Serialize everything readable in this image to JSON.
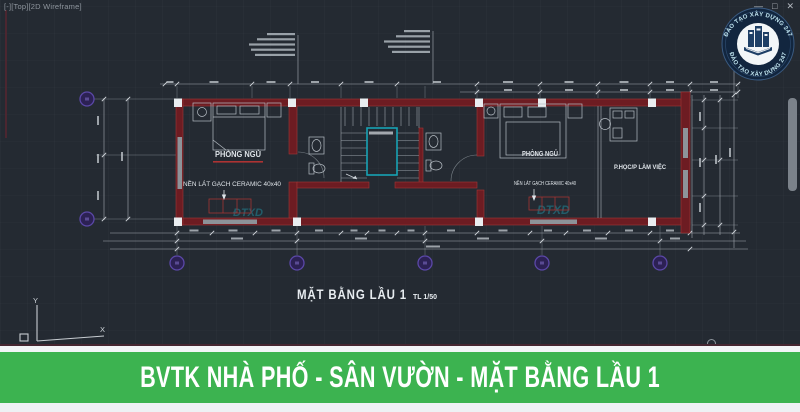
{
  "viewport_label": "[-][Top][2D Wireframe]",
  "window_controls": {
    "minimize": "—",
    "maximize": "□",
    "close": "✕"
  },
  "logo": {
    "arc_top": "ĐÀO TẠO XÂY DỰNG 247",
    "arc_bottom": "ĐÀO TẠO XÂY DỰNG 247"
  },
  "plan": {
    "title": "MẶT BẰNG LẦU 1",
    "scale": "TL 1/50",
    "bedroom_left": {
      "name": "PHÒNG NGỦ",
      "floor_note": "NỀN LÁT GẠCH CERAMIC 40x40"
    },
    "bedroom_right": {
      "name": "PHÒNG NGỦ",
      "floor_note": "NỀN LÁT GẠCH CERAMIC 40x40"
    },
    "study": {
      "name": "P.HỌC/P LÀM VIỆC"
    },
    "watermark": "ĐTXD"
  },
  "ucs": {
    "x": "X",
    "y": "Y"
  },
  "banner": {
    "text": "BVTK NHÀ PHỐ - SÂN VƯỜN - MẶT BẰNG LẦU 1"
  },
  "colors": {
    "background": "#242a32",
    "wall_red": "#6d1c22",
    "stair_teal": "#17a3b4",
    "grid_bubble_purple": "#2c2154",
    "banner_green": "#3cb350",
    "dimension_white": "#c6ccd2"
  }
}
